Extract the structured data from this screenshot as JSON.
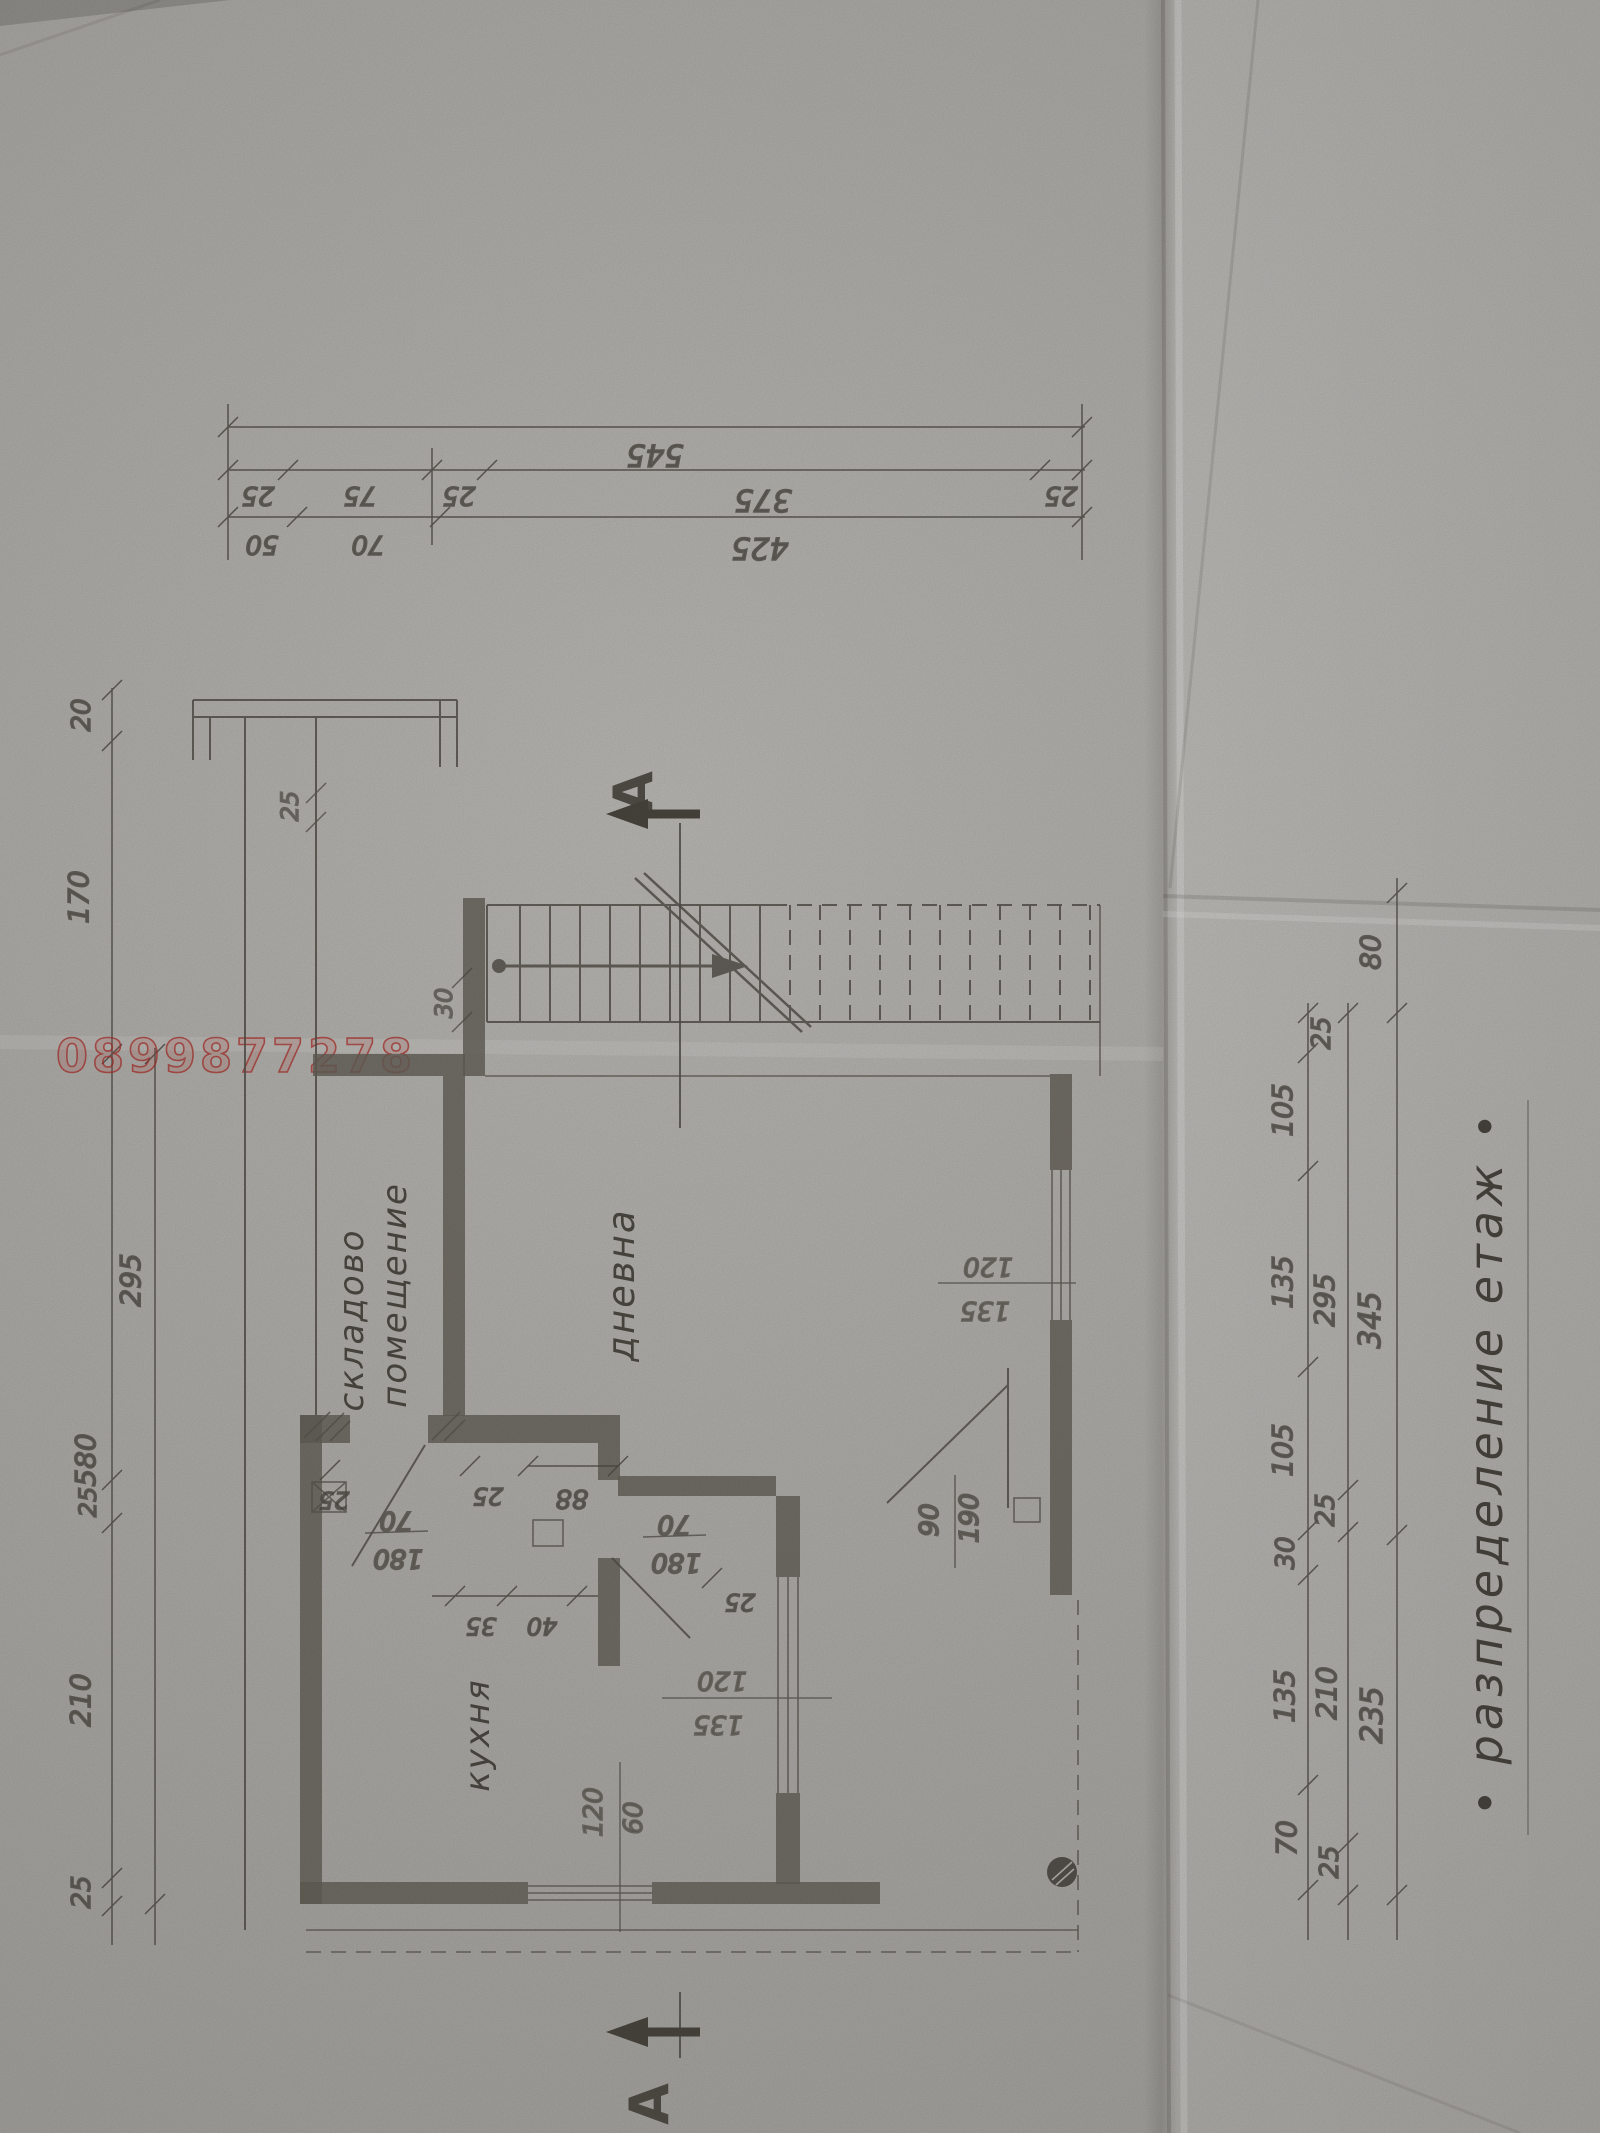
{
  "watermark": "0899877278",
  "title": "• разпределение етаж •",
  "section_letter": "А",
  "rooms": {
    "storage_line1": "складово",
    "storage_line2": "помещение",
    "living": "дневна",
    "kitchen": "кухня"
  },
  "dims": {
    "top": {
      "total": "545",
      "row2": [
        "25",
        "75",
        "25",
        "375",
        "25"
      ],
      "row3": [
        "50",
        "70",
        "425"
      ]
    },
    "left": {
      "segments": [
        "20",
        "170",
        "295",
        "25",
        "210",
        "25"
      ],
      "total": "580",
      "porch_gap": "25"
    },
    "right": {
      "inner": [
        "25",
        "105",
        "135",
        "105",
        "30",
        "135",
        "70"
      ],
      "middle": [
        "295",
        "25",
        "210",
        "25"
      ],
      "outer": [
        "80",
        "345",
        "235"
      ]
    },
    "stair_tread": "30",
    "doors": {
      "storage": [
        "70",
        "180"
      ],
      "living": [
        "70",
        "180"
      ],
      "terrace": [
        "90",
        "190"
      ]
    },
    "windows": {
      "living_east": [
        "120",
        "135"
      ],
      "kitchen_south": [
        "120",
        "135"
      ],
      "kitchen_small": [
        "120",
        "60"
      ]
    },
    "misc": [
      "25",
      "25",
      "88",
      "25",
      "35",
      "40"
    ]
  }
}
